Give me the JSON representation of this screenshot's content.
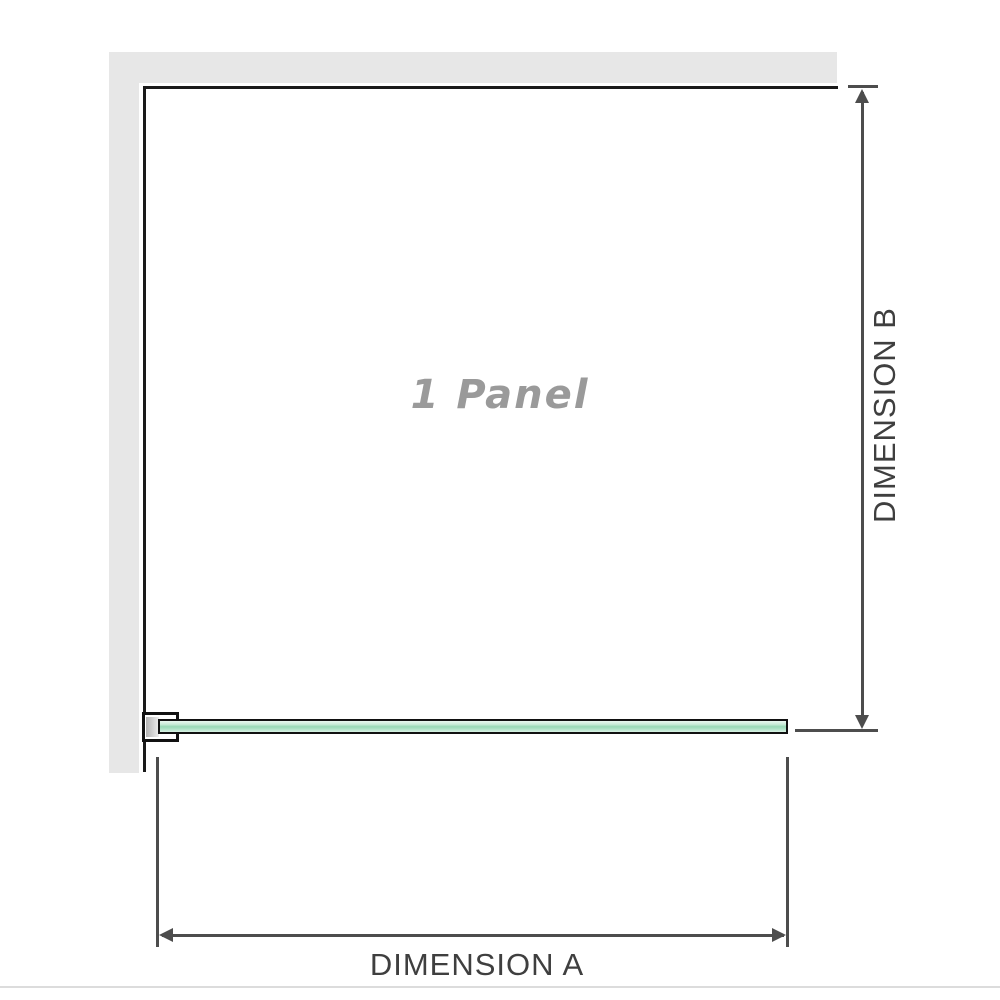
{
  "diagram": {
    "panel": {
      "label": "1 Panel"
    },
    "dimension_a": {
      "label": "DIMENSION A"
    },
    "dimension_b": {
      "label": "DIMENSION B"
    }
  },
  "icons": {
    "arrow_up": "dimension-b-arrowhead-up",
    "arrow_down": "dimension-b-arrowhead-down",
    "arrow_left": "dimension-a-arrowhead-left",
    "arrow_right": "dimension-a-arrowhead-right"
  },
  "colors": {
    "background": "#ffffff",
    "wall_fill": "#e7e7e7",
    "frame_line": "#1a1a1a",
    "dimension_line": "#4d4d4d",
    "dimension_text": "#3f3f3f",
    "panel_text": "#9a9a9a",
    "glass_fill_light": "#d9f1e4",
    "glass_fill_mid": "#98d8b6",
    "glass_border": "#111111",
    "divider": "#dcdcdc"
  }
}
